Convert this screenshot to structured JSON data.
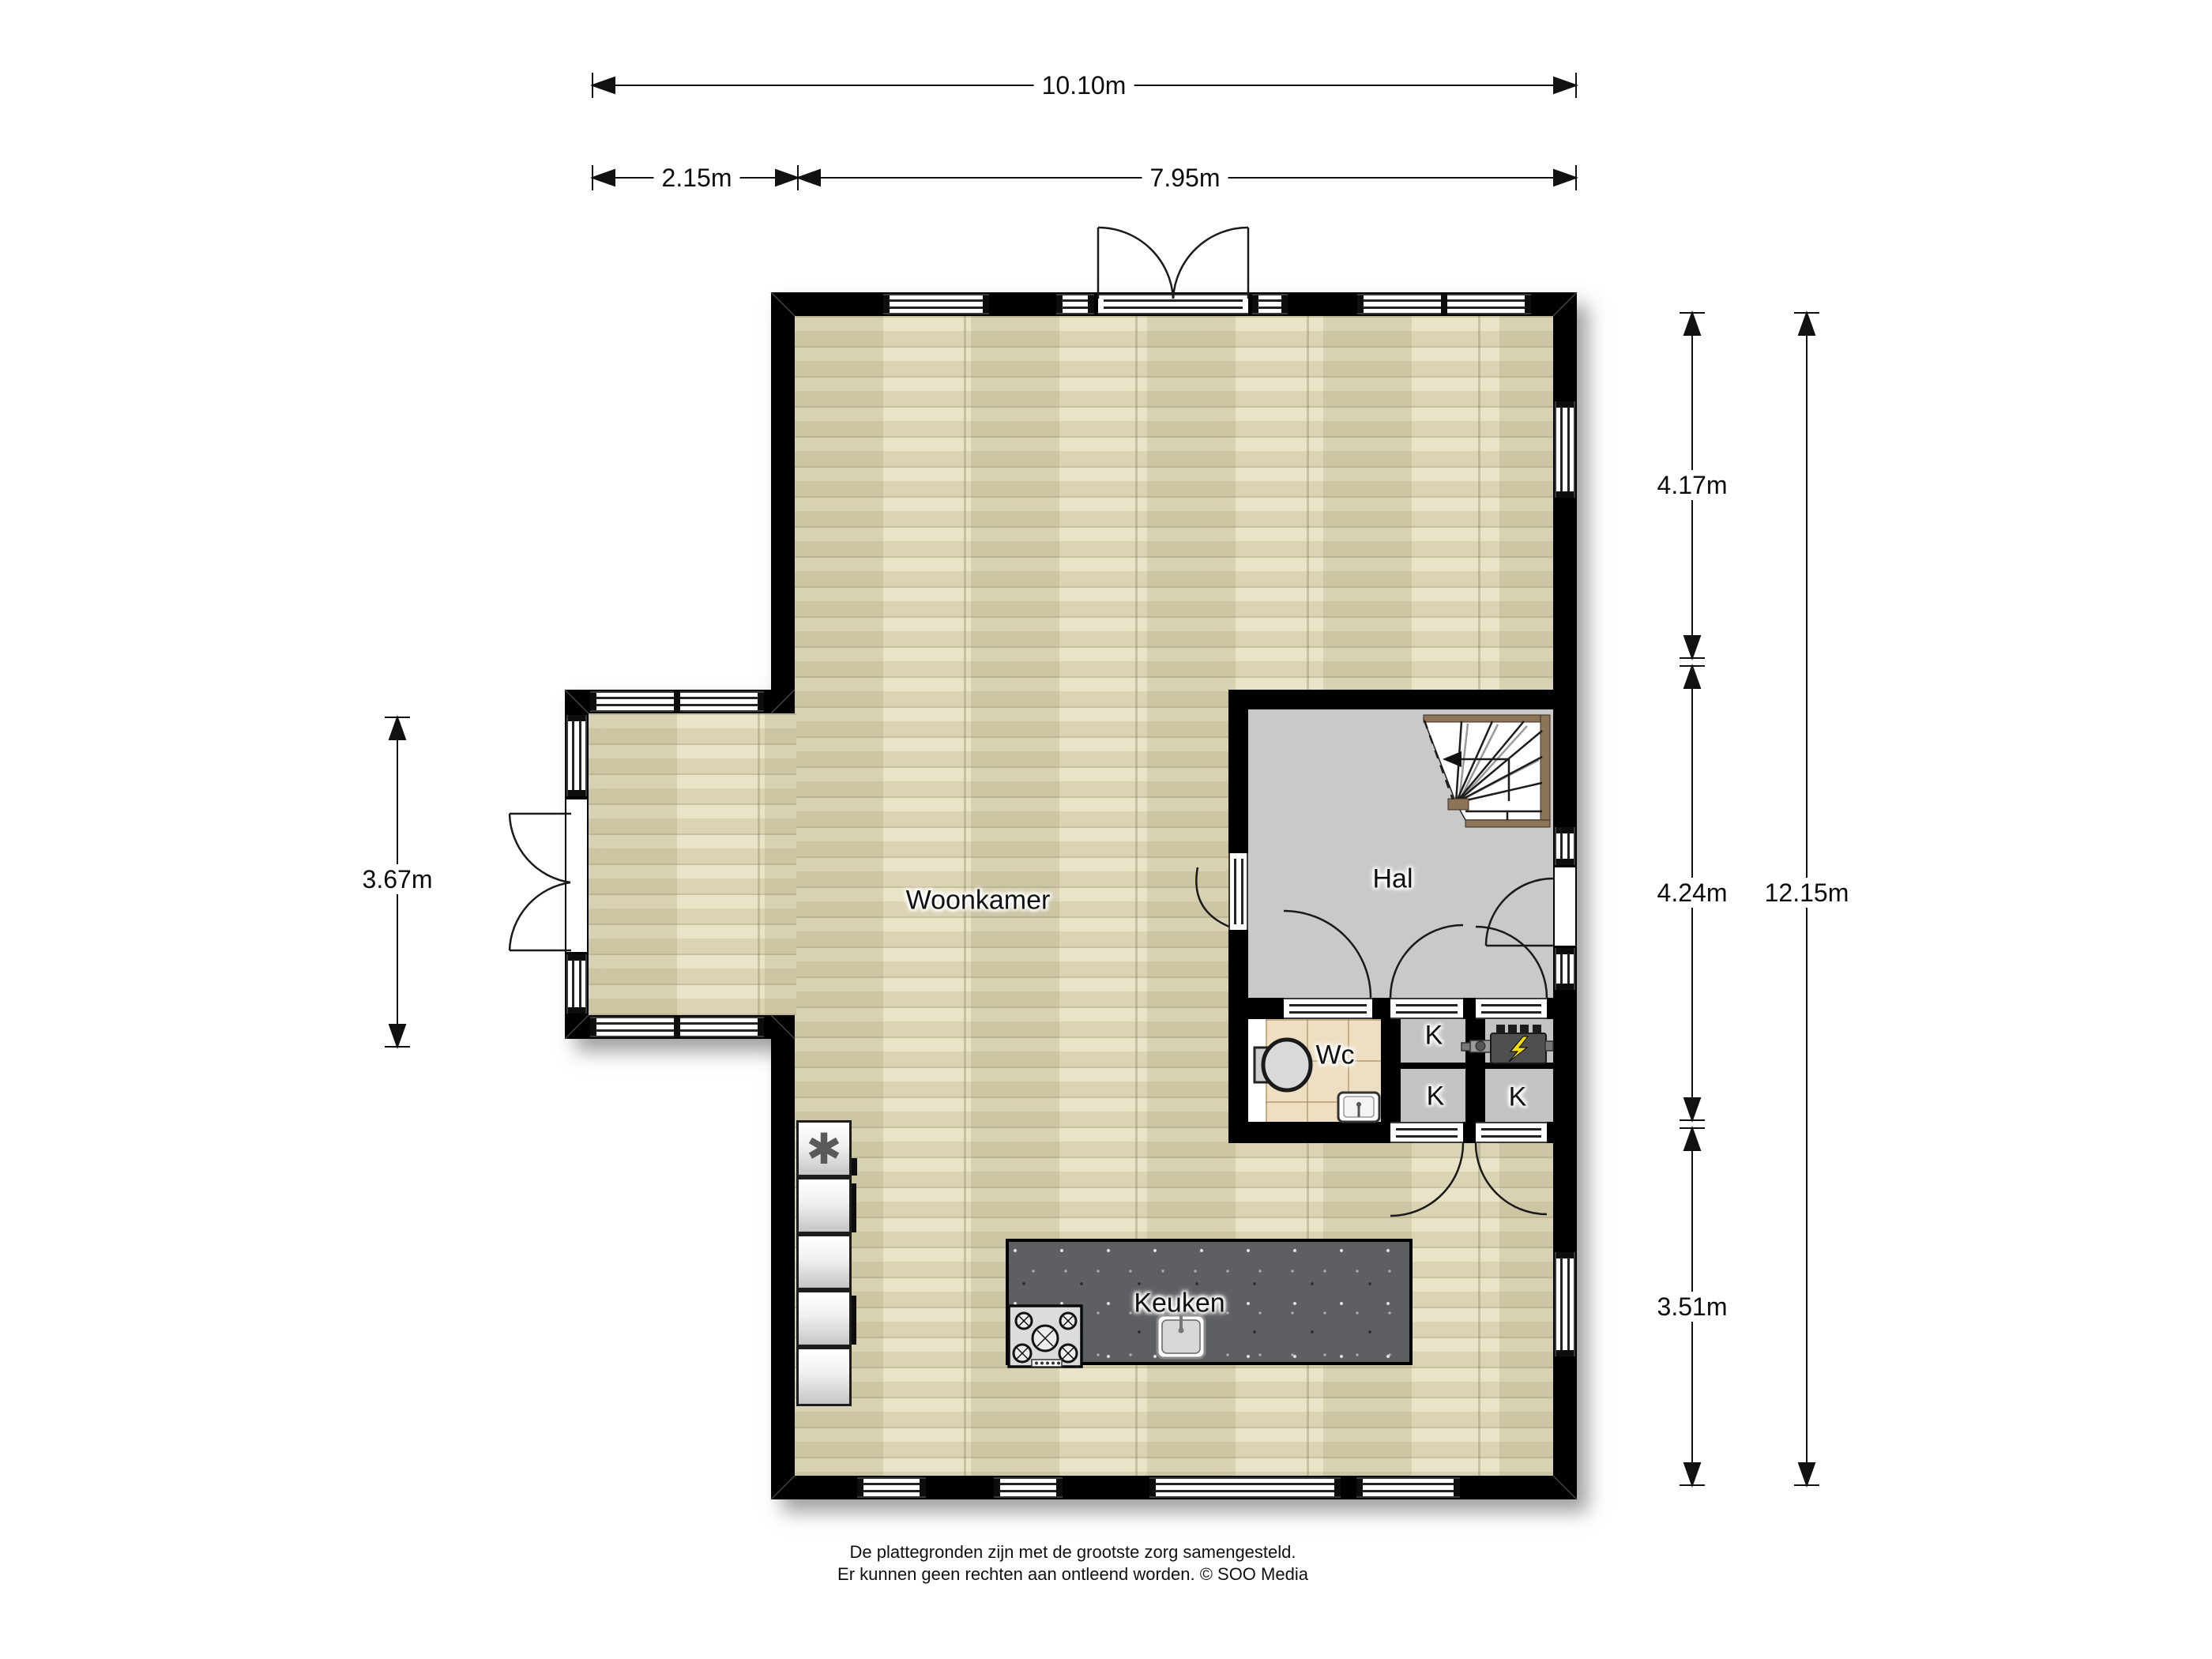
{
  "plan": {
    "rooms": {
      "living": "Woonkamer",
      "hall": "Hal",
      "toilet": "Wc",
      "closet_top": "K",
      "closet_bottom": "K",
      "closet_right": "K",
      "kitchen": "Keuken"
    },
    "dimensions": {
      "total_width": "10.10m",
      "bay_width": "2.15m",
      "main_width": "7.95m",
      "bay_height": "3.67m",
      "right_top": "4.17m",
      "right_middle": "4.24m",
      "right_bottom": "3.51m",
      "total_height": "12.15m"
    },
    "symbols": {
      "freezer": "✱"
    },
    "colors": {
      "wall": "#000000",
      "wood": "#e9e4c8",
      "hall_floor": "#c9c9c9",
      "closet_floor": "#c3c3c3",
      "tile_floor": "#eedfc2",
      "island_top": "#5d5f63",
      "stair_wood": "#8d7357",
      "boiler_flash": "#f4dd00"
    }
  },
  "footer": {
    "line1": "De plattegronden zijn met de grootste zorg samengesteld.",
    "line2": "Er kunnen geen rechten aan ontleend worden. © SOO Media"
  }
}
